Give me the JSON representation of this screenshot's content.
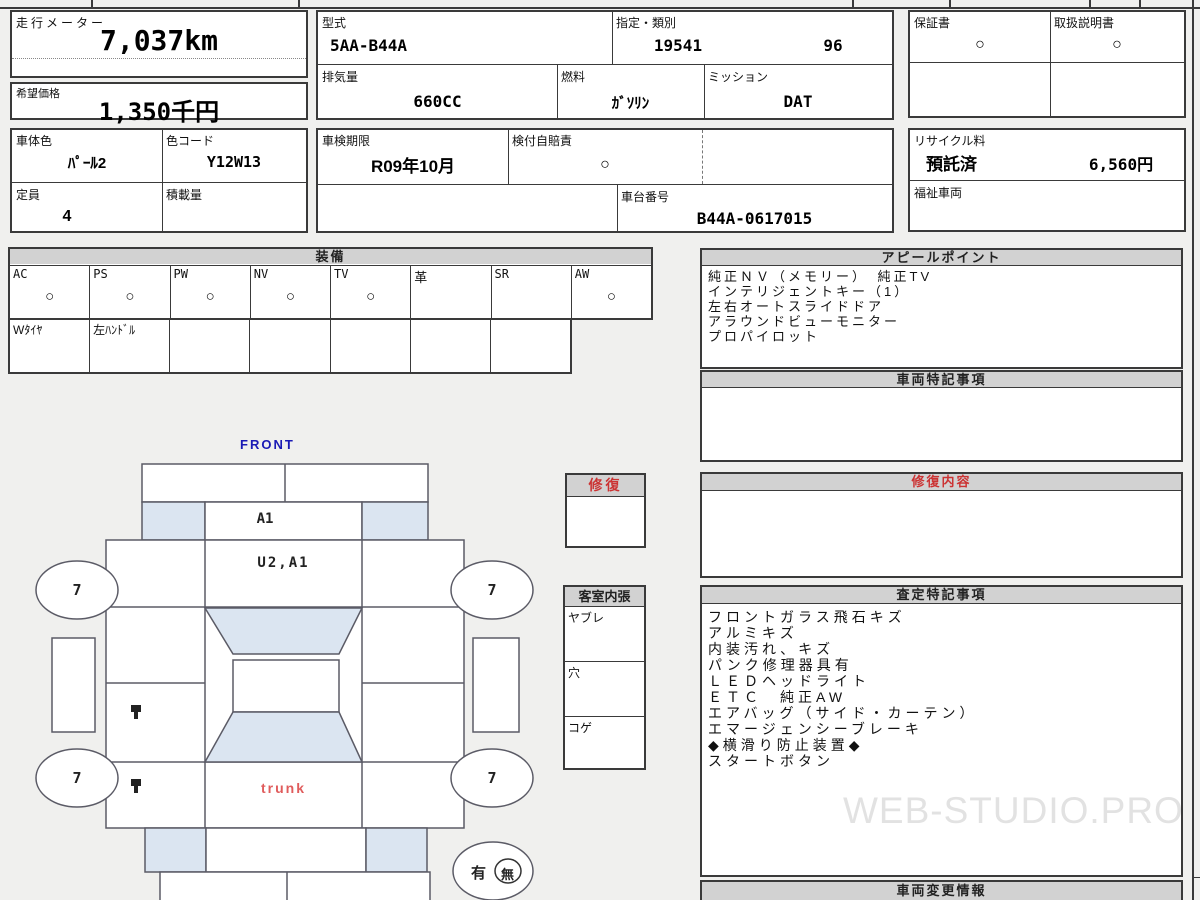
{
  "meter": {
    "label": "走行メーター",
    "value": "7,037km"
  },
  "price": {
    "label": "希望価格",
    "value": "1,350千円"
  },
  "left_info": {
    "body_color": {
      "label": "車体色",
      "value": "ﾊﾟｰﾙ2"
    },
    "color_code": {
      "label": "色コード",
      "value": "Y12W13"
    },
    "capacity": {
      "label": "定員",
      "value": "4"
    },
    "load": {
      "label": "積載量",
      "value": ""
    }
  },
  "spec": {
    "model": {
      "label": "型式",
      "value": "5AA-B44A"
    },
    "class": {
      "label": "指定・類別",
      "value1": "19541",
      "value2": "96"
    },
    "displacement": {
      "label": "排気量",
      "value": "660CC"
    },
    "fuel": {
      "label": "燃料",
      "value": "ｶﾞｿﾘﾝ"
    },
    "mission": {
      "label": "ミッション",
      "value": "DAT"
    }
  },
  "docs": {
    "warranty": {
      "label": "保証書",
      "value": "○"
    },
    "manual": {
      "label": "取扱説明書",
      "value": "○"
    }
  },
  "inspection": {
    "expiry": {
      "label": "車検期限",
      "value": "R09年10月"
    },
    "insurance": {
      "label": "検付自賠責",
      "value": "○"
    },
    "chassis": {
      "label": "車台番号",
      "value": "B44A-0617015"
    }
  },
  "recycle": {
    "label": "リサイクル料",
    "status": "預託済",
    "fee": "6,560円"
  },
  "welfare": {
    "label": "福祉車両"
  },
  "equipment": {
    "title": "装備",
    "items": [
      {
        "label": "AC",
        "value": "○"
      },
      {
        "label": "PS",
        "value": "○"
      },
      {
        "label": "PW",
        "value": "○"
      },
      {
        "label": "NV",
        "value": "○"
      },
      {
        "label": "TV",
        "value": "○"
      },
      {
        "label": "革",
        "value": ""
      },
      {
        "label": "SR",
        "value": ""
      },
      {
        "label": "AW",
        "value": "○"
      }
    ],
    "notes": [
      "Wﾀｲﾔ",
      "左ﾊﾝﾄﾞﾙ",
      "",
      "",
      "",
      "",
      ""
    ]
  },
  "appeal": {
    "title": "アピールポイント",
    "lines": [
      "純正ＮＶ（メモリー）　純正TV",
      "インテリジェントキー（1）",
      "左右オートスライドドア",
      "アラウンドビューモニター",
      "プロパイロット"
    ]
  },
  "vehicle_notes": {
    "title": "車両特記事項"
  },
  "repair_detail": {
    "title": "修復内容"
  },
  "assessment": {
    "title": "査定特記事項",
    "lines": [
      "フロントガラス飛石キズ",
      "アルミキズ",
      "内装汚れ、キズ",
      "パンク修理器具有",
      "ＬＥＤヘッドライト",
      "ＥＴＣ　純正AW",
      "エアバッグ（サイド・カーテン）",
      "エマージェンシーブレーキ",
      "◆横滑り防止装置◆",
      "スタートボタン"
    ]
  },
  "change_info": {
    "title": "車両変更情報"
  },
  "diagram": {
    "front_label": "FRONT",
    "hood_mark": "A1",
    "windshield_mark": "U2,A1",
    "trunk_label": "trunk",
    "wheel_marks": [
      "7",
      "7",
      "7",
      "7"
    ],
    "presence_yes": "有",
    "presence_no": "無",
    "repair_box_title": "修復",
    "interior": {
      "title": "客室内張",
      "rows": [
        "ヤブレ",
        "穴",
        "コゲ"
      ]
    }
  },
  "watermark": "WEB-STUDIO.PRO",
  "colors": {
    "accent_blue": "#1b1bb5",
    "accent_red": "#cc3333",
    "diagram_fill": "#dbe5f1",
    "header_band": "#d2d2d2",
    "trunk_red": "#e05c5c"
  }
}
